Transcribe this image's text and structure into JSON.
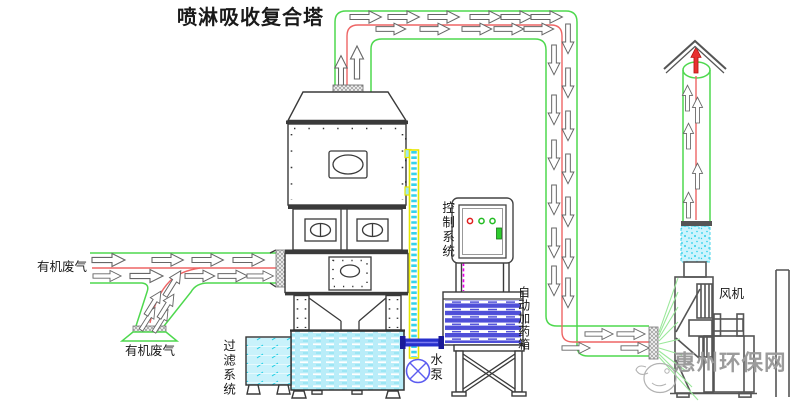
{
  "title": "喷淋吸收复合塔",
  "labels": {
    "organic_gas_left": "有机废气",
    "organic_gas_branch": "有机废气",
    "filter_system": "过滤系统",
    "control_system": "控制系统",
    "water_pump": "水泵",
    "auto_dosing_box": "自动加药箱",
    "fan": "风机"
  },
  "watermark": {
    "text": "惠州环保网"
  },
  "indicator_lights": [
    "red",
    "green",
    "green"
  ],
  "colors": {
    "duct_outline_green": "#4ed84e",
    "flow_line_red": "#ee6565",
    "tank_water_cyan": "#b9edf9",
    "dosing_stripe_blue": "#4f4fd8",
    "water_pipe_blue": "#2830cc",
    "pump_blue": "#5c5cf0",
    "control_signal_magenta": "#e800e8",
    "spray_pipe_yellow": "#e6e600",
    "watermark_gray": "#9b9b9b"
  }
}
